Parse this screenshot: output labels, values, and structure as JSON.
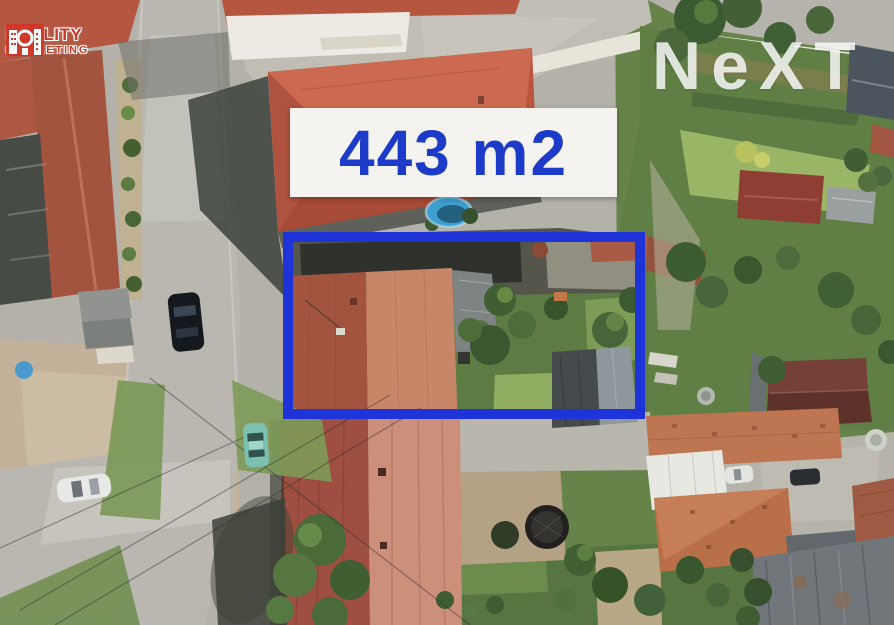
{
  "overlay": {
    "area_label": "443 m2",
    "area_label_color": "#1d3bc9",
    "banner_bg": "#f4f3f0",
    "plot_outline_color": "#1e33d8"
  },
  "watermarks": {
    "agency": {
      "line1": "REALITY",
      "line2": "MARKETING",
      "color": "#d23527"
    },
    "brand": {
      "text": "NeXT",
      "color": "#ffffff"
    }
  },
  "scene": {
    "type": "aerial-drone-photo",
    "visible_objects": [
      "red hip-roof house",
      "long farmhouse red roof",
      "village street intersection",
      "gardens with trees",
      "swimming pool",
      "trampoline",
      "parked cars",
      "white boundary wall",
      "neighbor roofs"
    ]
  }
}
